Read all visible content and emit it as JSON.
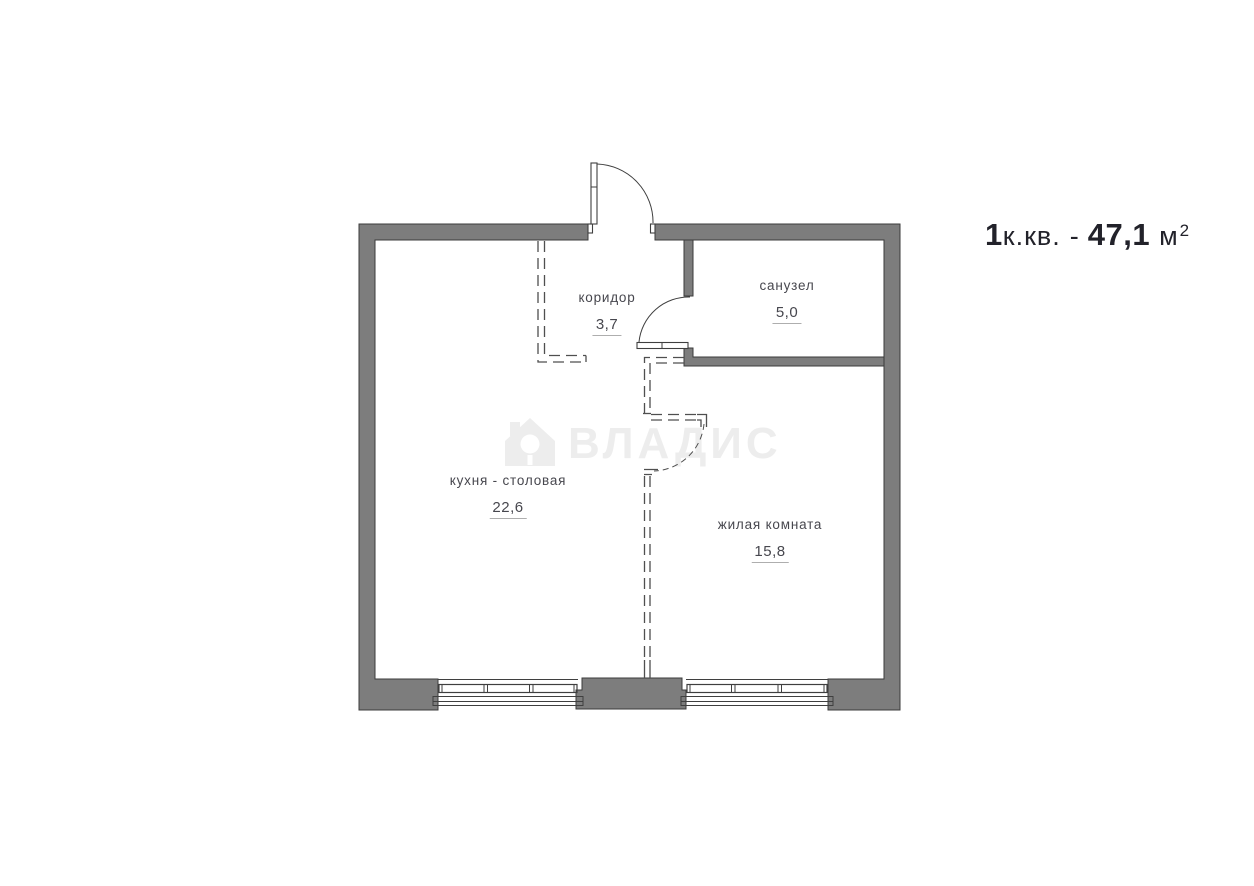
{
  "title": {
    "prefix": "1",
    "type": "к.кв.",
    "dash": "-",
    "area": "47,1",
    "unit": "м",
    "sup": "2"
  },
  "watermark": {
    "brand": "ВЛАДИС"
  },
  "rooms": {
    "corridor": {
      "name": "коридор",
      "area": "3,7"
    },
    "bathroom": {
      "name": "санузел",
      "area": "5,0"
    },
    "kitchen": {
      "name": "кухня - столовая",
      "area": "22,6"
    },
    "living": {
      "name": "жилая комната",
      "area": "15,8"
    }
  },
  "colors": {
    "wall": "#7d7d7d",
    "wall-outline": "#3b3b3b",
    "line": "#3f3f3f",
    "dash": "#4f4f4f",
    "text": "#47474e",
    "underline": "#aeaeae",
    "title": "#22222a",
    "watermark": "#ededed"
  }
}
